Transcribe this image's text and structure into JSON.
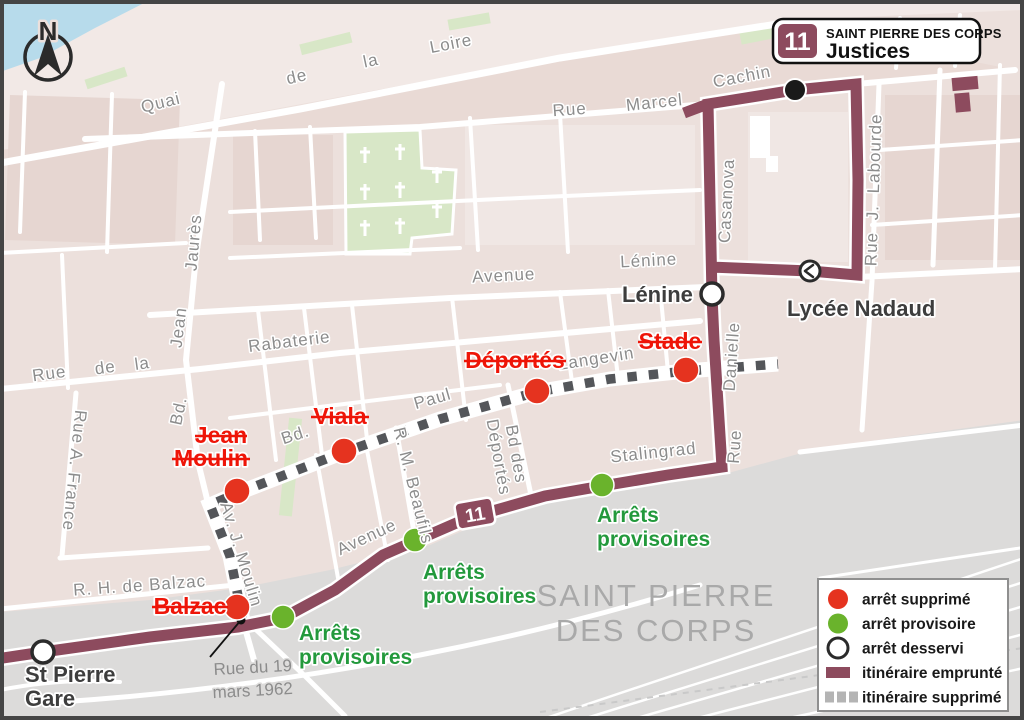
{
  "header": {
    "line": "11",
    "network": "SAINT PIERRE DES CORPS",
    "destination": "Justices"
  },
  "compass": {
    "north": "N"
  },
  "route_badge": "11",
  "area": [
    "SAINT PIERRE",
    "DES CORPS"
  ],
  "legend": {
    "items": [
      {
        "label": "arrêt supprimé",
        "symbol": "red-dot",
        "color": "#e5331f"
      },
      {
        "label": "arrêt provisoire",
        "symbol": "green-dot",
        "color": "#6ab32c"
      },
      {
        "label": "arrêt desservi",
        "symbol": "white-dot",
        "color": "#ffffff"
      },
      {
        "label": "itinéraire emprunté",
        "symbol": "solid-line",
        "color": "#8d4b5e"
      },
      {
        "label": "itinéraire supprimé",
        "symbol": "dashed-line",
        "color": "#b4b4b4"
      }
    ]
  },
  "stops": {
    "removed": [
      {
        "lines": [
          "Jean",
          "Moulin"
        ]
      },
      {
        "lines": [
          "Viala"
        ]
      },
      {
        "lines": [
          "Déportés"
        ]
      },
      {
        "lines": [
          "Stade"
        ]
      },
      {
        "lines": [
          "Balzac"
        ]
      }
    ],
    "temporary": {
      "lines": [
        "Arrêts",
        "provisoires"
      ]
    },
    "served": [
      {
        "lines": [
          "St Pierre",
          "Gare"
        ]
      },
      {
        "lines": [
          "Lénine"
        ]
      },
      {
        "lines": [
          "Lycée Nadaud"
        ]
      }
    ]
  },
  "streets": {
    "quai": [
      "Quai",
      "de",
      "la",
      "Loire"
    ],
    "rue_marcel": [
      "Rue",
      "Marcel"
    ],
    "cachin": "Cachin",
    "avenue": "Avenue",
    "lenine": "Lénine",
    "rabaterie": "Rabaterie",
    "rue_de_la": [
      "Rue",
      "de",
      "la"
    ],
    "jaures": "Jaurès",
    "jean": "Jean",
    "bd_jean": "Bd.",
    "rue_a_france": "Rue A. France",
    "bd_paul": "Bd.",
    "paul": "Paul",
    "langevin": "Langevin",
    "beaufils": "R. M. Beaufils",
    "bd_des_deportes": [
      "Bd des",
      "Déportés"
    ],
    "av_j_moulin": "Av. J. Moulin",
    "casanova": "Casanova",
    "danielle": "Danielle",
    "rue_word": "Rue",
    "labourde": "Rue J. Labourde",
    "stalingrad": "Stalingrad",
    "avenue_sw": "Avenue",
    "balzac_street": "R. H. de Balzac",
    "rue_19": [
      "Rue du 19",
      "mars 1962"
    ]
  },
  "colors": {
    "route": "#8d4b5e",
    "removed_stop": "#e5331f",
    "temporary_stop": "#6ab32c",
    "served_stop": "#ffffff",
    "removed_route_dash": "#54565a",
    "background": "#ece0dc",
    "railway_zone": "#dcdbda",
    "river": "#b7dbeb",
    "park": "#d8e7c7"
  }
}
